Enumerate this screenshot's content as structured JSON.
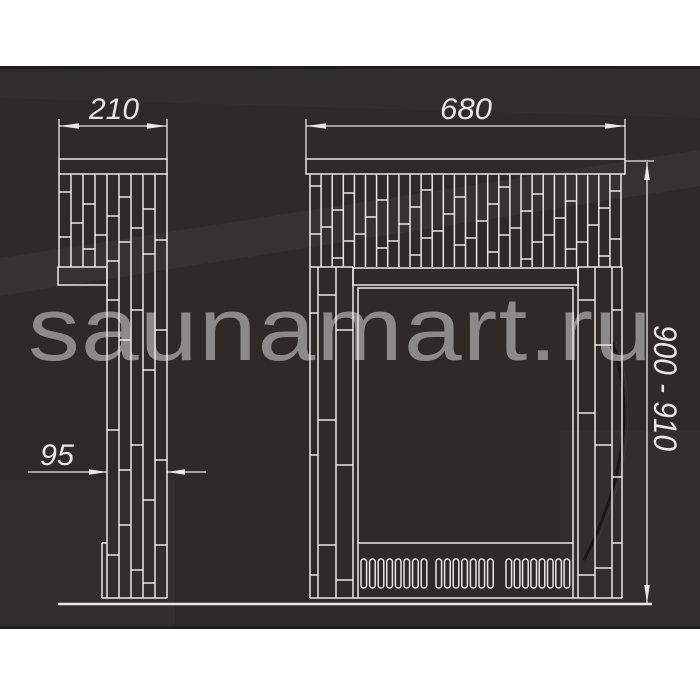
{
  "colors": {
    "page_background": "#ffffff",
    "panel_background": "#2c2b29",
    "line": "#e9e7e3",
    "watermark": "#8a8a8a"
  },
  "watermark": {
    "text": "saunamart.ru"
  },
  "drawing": {
    "side_view": {
      "width_dimension": "210",
      "depth_dimension": "95"
    },
    "front_view": {
      "width_dimension": "680",
      "height_dimension": "900 - 910"
    }
  }
}
